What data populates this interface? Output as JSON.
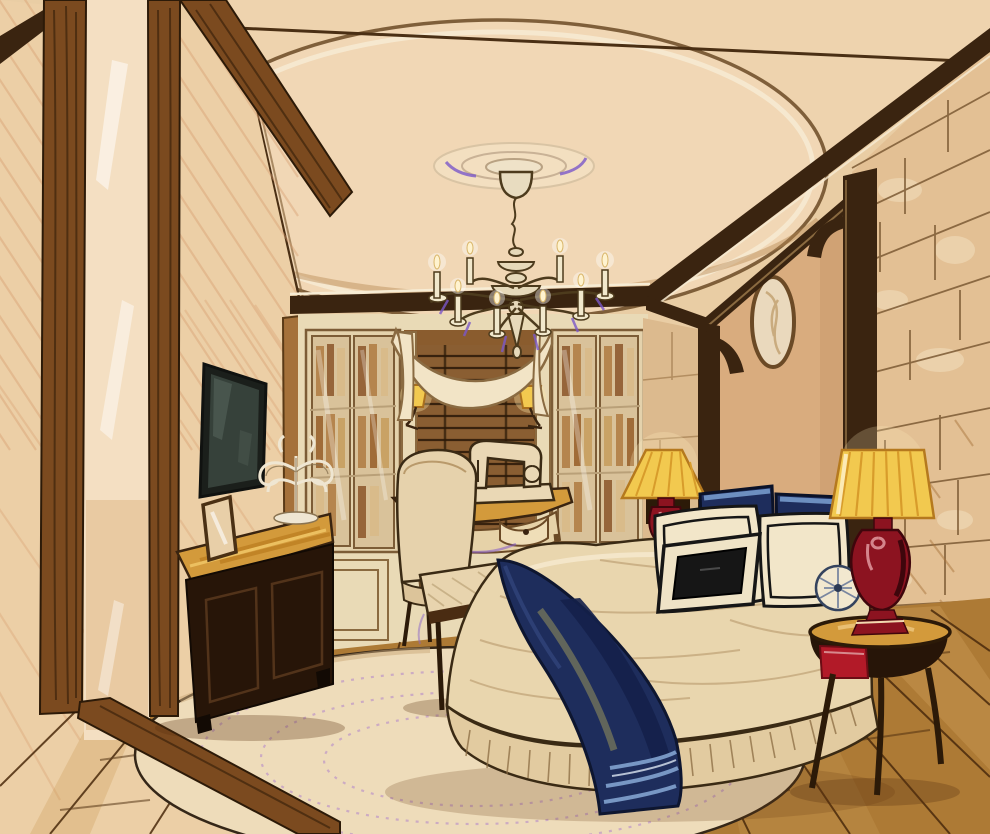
{
  "artwork": {
    "medium": "watercolor-and-marker interior sketch",
    "subject": "classic bedroom with stone accent wall and bed nook",
    "objects": [
      "tray ceiling with oval dome and ceiling medallion",
      "candle chandelier",
      "floor-to-ceiling wood framed window wall",
      "built-in bookcases with glass doors",
      "swag valance over woven-wood blind",
      "pair of swing-arm sconces with gold shades",
      "writing desk with vintage sewing machine",
      "upholstered desk chair",
      "wall-mounted flat screen tv",
      "dark wood credenza with photo frame and candelabra",
      "upholstered bench",
      "bed with tailored skirt and navy throw",
      "white banded pillows, navy shams, black lumbar pillow",
      "round pleated bolster cushion",
      "two red urn lamps with pleated gold shades",
      "round side table with red drawer",
      "stone block wall",
      "arched bed nook with oval medallion",
      "oval cream rug with lavender stitching",
      "plank wood floor"
    ]
  },
  "palette": {
    "paper": "#e9cda4",
    "wallLeft": "#eccfa6",
    "ceiling": "#eed3ae",
    "domeFace": "#f1d7b5",
    "trimDark": "#3a2410",
    "woodMid": "#7b4a1f",
    "woodGrain": "#45280e",
    "glassWarm": "#f4dfc2",
    "cream": "#f2e4c6",
    "cabinetCream": "#e9dab6",
    "bookTan": "#b5854e",
    "blindBrown": "#8a5e32",
    "shadeYellow": "#f2c94f",
    "lampRed": "#8c1320",
    "navy": "#1e2d5c",
    "navyDeep": "#0f1a38",
    "stripeBlue": "#82a3cf",
    "pillowWhite": "#f2e6c9",
    "black": "#161616",
    "stone": "#e3c094",
    "stoneStrip": "#dcba8e",
    "mortar": "#7c5a34",
    "nookWall": "#d9ac7e",
    "floorWood": "#ad7a35",
    "floorSeam": "#4a2a0c",
    "rugCream": "#eedcba",
    "rugDot": "#b78cc9",
    "goldTop": "#d39a3b",
    "dresserDark": "#271508",
    "tvScreen": "#36413a",
    "accentPurple": "#7a58c8",
    "outline": "#4d3b1d",
    "hatch": "#d79a6d",
    "duvetCream": "#e9d6ae",
    "skirtCream": "#e2cba0"
  }
}
